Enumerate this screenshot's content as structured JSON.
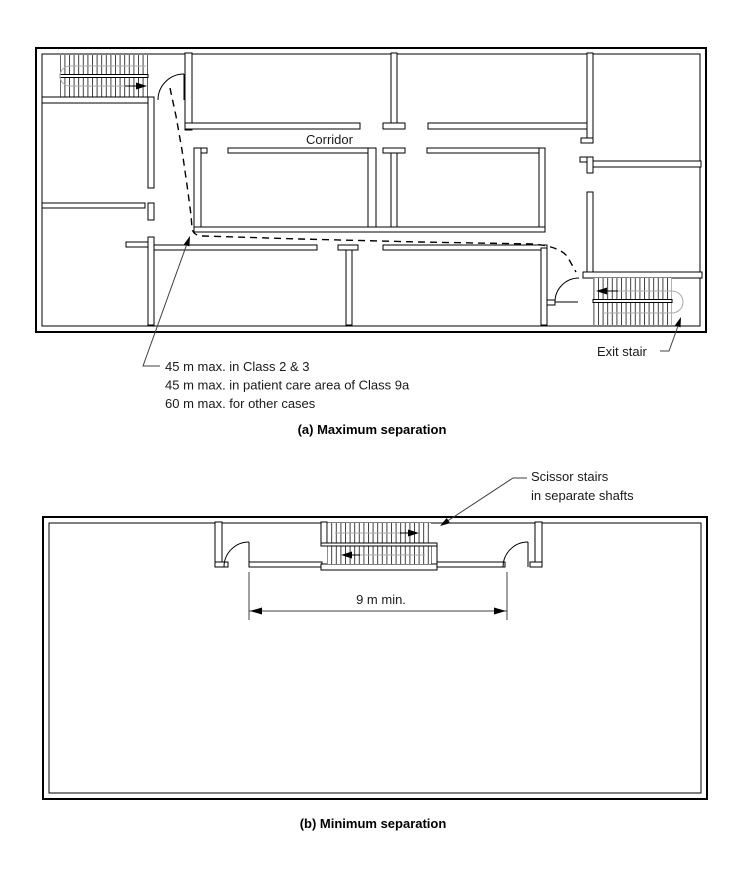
{
  "page": {
    "background": "#ffffff"
  },
  "figure": {
    "panel_a": {
      "corridor_label": "Corridor",
      "annotation_lines": [
        "45 m max. in Class 2 & 3",
        "45 m max. in patient care area of Class 9a",
        "60 m max. for other cases"
      ],
      "exit_stair_label": "Exit stair",
      "caption": "(a) Maximum separation"
    },
    "panel_b": {
      "scissor_label_line1": "Scissor stairs",
      "scissor_label_line2": "in separate shafts",
      "dimension_label": "9 m min.",
      "caption": "(b) Minimum separation"
    },
    "colors": {
      "wall_line": "#000000",
      "walk_line": "#aaaaaa",
      "leader_line": "#404040",
      "background": "#ffffff"
    }
  }
}
